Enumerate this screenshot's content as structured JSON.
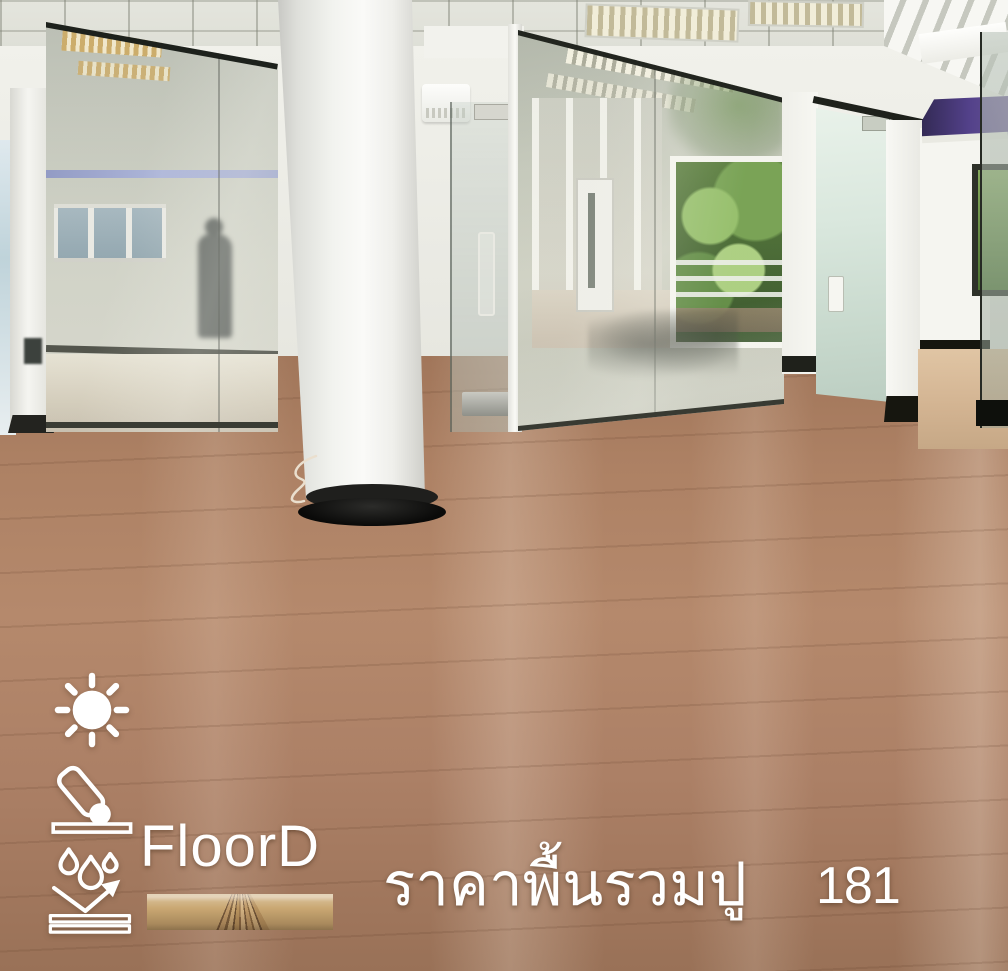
{
  "scene_description": "Empty office interior with glass partitions, white cylindrical column with black base, suspended tile ceiling, exterior windows with green trees, and light-brown wooden laminate flooring",
  "overlay": {
    "brand": "FloorD",
    "caption": "ราคาพื้นรวมปู",
    "price": "181",
    "icons": [
      {
        "name": "sun-icon"
      },
      {
        "name": "impact-resistance-icon"
      },
      {
        "name": "water-resistance-icon"
      }
    ]
  },
  "palette": {
    "floor_wood": "#ab7f62",
    "floor_seam": "#6b4630",
    "glass_tint": "#c6ccbe",
    "frame_dark": "#23251e",
    "column_white": "#f4f4f1",
    "column_base_black": "#1a1a17",
    "ceiling_grey": "#d8d9d1",
    "greenery_green": "#5f8a3e",
    "clerestory_purple": "#53418a",
    "overlay_text": "#ffffff"
  }
}
